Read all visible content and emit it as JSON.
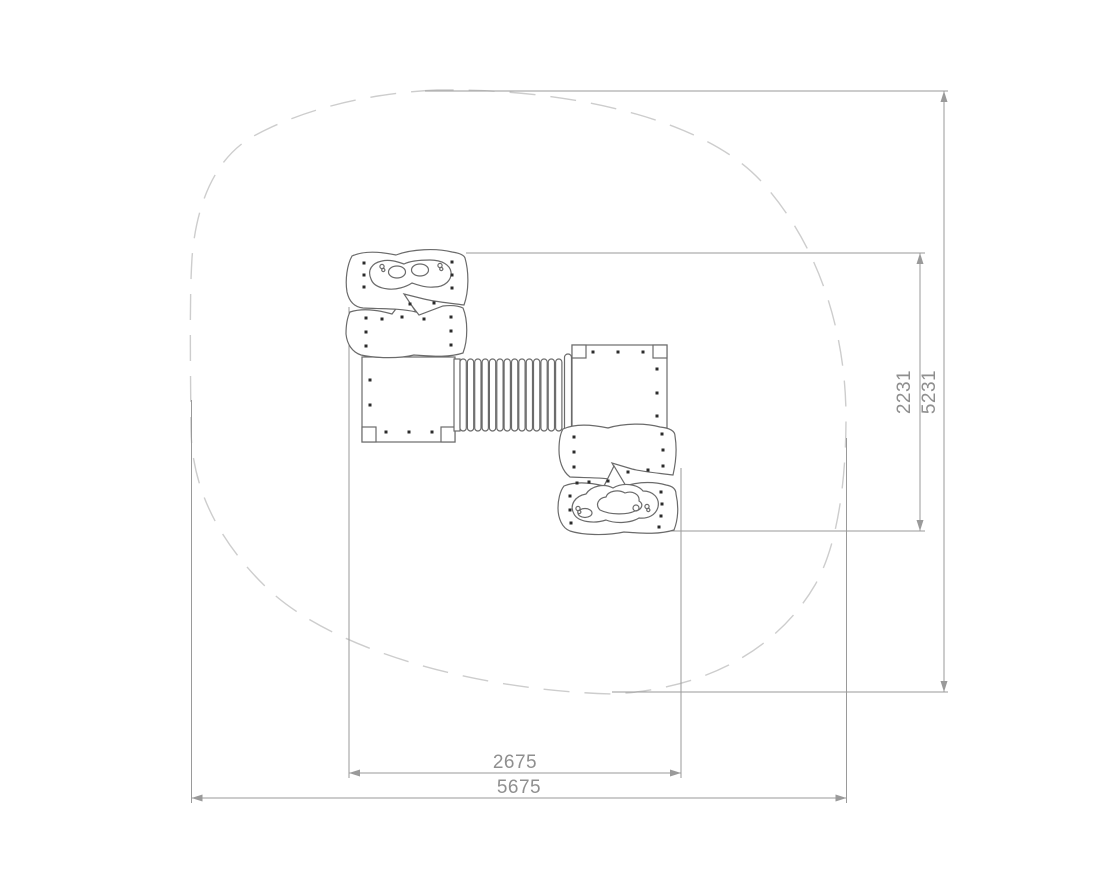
{
  "drawing": {
    "dimension_labels": {
      "equipment_width": "2675",
      "safety_zone_width": "5675",
      "equipment_depth": "2231",
      "safety_zone_depth": "5231"
    },
    "colors": {
      "dimension_lines": "#9a9a9a",
      "dimension_text": "#8f8f8f",
      "equipment_outline": "#6b6b6b",
      "safety_zone_outline": "#cdcdcd",
      "climbing_hold_dots": "#2b2b2b",
      "background": "#ffffff"
    }
  }
}
